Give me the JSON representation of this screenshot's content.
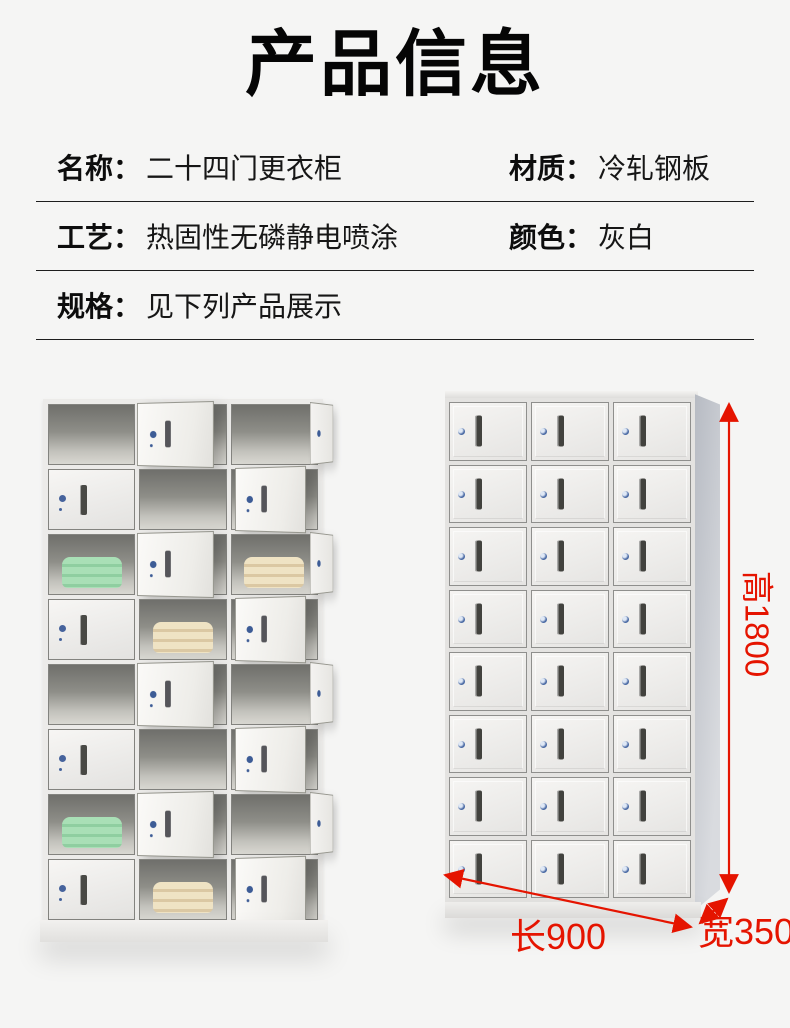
{
  "title": "产品信息",
  "specs": {
    "rows": [
      {
        "cells": [
          {
            "label": "名称：",
            "value": "二十四门更衣柜"
          },
          {
            "label": "材质：",
            "value": "冷轧钢板"
          }
        ]
      },
      {
        "cells": [
          {
            "label": "工艺：",
            "value": "热固性无磷静电喷涂"
          },
          {
            "label": "颜色：",
            "value": "灰白"
          }
        ]
      },
      {
        "cells": [
          {
            "label": "规格：",
            "value": "见下列产品展示"
          }
        ]
      }
    ]
  },
  "dimensions": {
    "height": "高1800",
    "length": "长900",
    "width": "宽350",
    "accent": "#e51400"
  },
  "lockers": {
    "door_count": 24,
    "open_view": {
      "rows": [
        {
          "type": "A",
          "item1": "shoes-gray",
          "item2": "heels-dark"
        },
        {
          "type": "B",
          "item": "cones-gray"
        },
        {
          "type": "A",
          "item1": "towel-green",
          "item2": "towel-beige"
        },
        {
          "type": "B",
          "item": "towel-beige"
        },
        {
          "type": "A",
          "item1": "shoes-white",
          "item2": "heels-tan"
        },
        {
          "type": "B",
          "item": "cones-beige"
        },
        {
          "type": "A",
          "item1": "towel-green",
          "item2": "sneaker-red"
        },
        {
          "type": "B",
          "item": "towel-beige"
        }
      ]
    },
    "closed_view": {
      "rows": 8,
      "cols": 3
    }
  }
}
